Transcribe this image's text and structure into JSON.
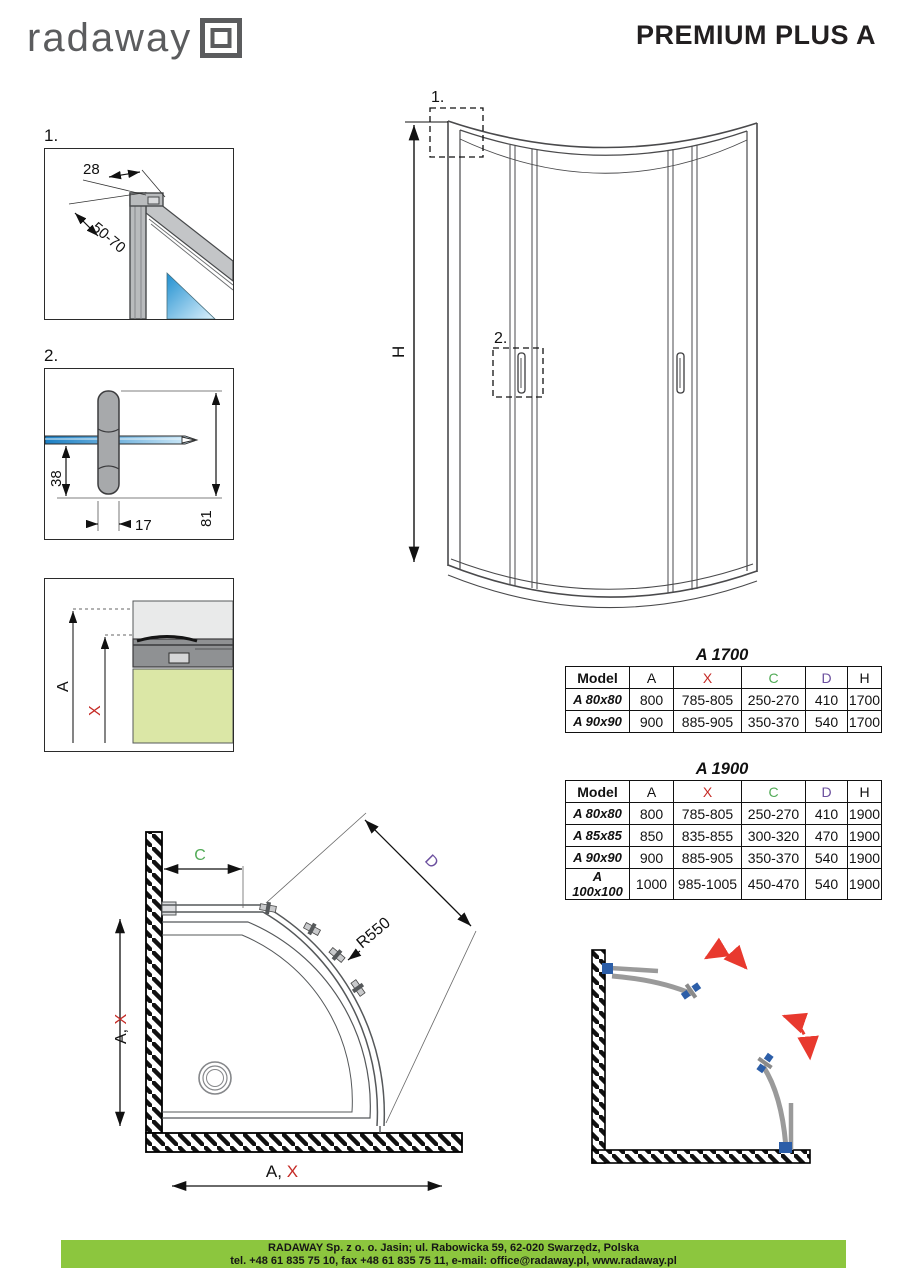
{
  "header": {
    "logo_text": "radaway",
    "title": "PREMIUM PLUS A"
  },
  "details": {
    "one": {
      "label": "1.",
      "dim_width": "28",
      "dim_range": "50-70"
    },
    "two": {
      "label": "2.",
      "dim_depth": "38",
      "dim_width": "17",
      "dim_height": "81"
    },
    "three": {
      "dim_a": "A",
      "dim_x": "X"
    }
  },
  "front_view": {
    "marker_top": "1.",
    "marker_handle": "2.",
    "dim_height": "H"
  },
  "tables": [
    {
      "title": "A 1700",
      "headers": [
        "Model",
        "A",
        "X",
        "C",
        "D",
        "H"
      ],
      "rows": [
        [
          "A 80x80",
          "800",
          "785-805",
          "250-270",
          "410",
          "1700"
        ],
        [
          "A 90x90",
          "900",
          "885-905",
          "350-370",
          "540",
          "1700"
        ]
      ]
    },
    {
      "title": "A 1900",
      "headers": [
        "Model",
        "A",
        "X",
        "C",
        "D",
        "H"
      ],
      "rows": [
        [
          "A 80x80",
          "800",
          "785-805",
          "250-270",
          "410",
          "1900"
        ],
        [
          "A 85x85",
          "850",
          "835-855",
          "300-320",
          "470",
          "1900"
        ],
        [
          "A 90x90",
          "900",
          "885-905",
          "350-370",
          "540",
          "1900"
        ],
        [
          "A 100x100",
          "1000",
          "985-1005",
          "450-470",
          "540",
          "1900"
        ]
      ]
    }
  ],
  "plan_view": {
    "dim_c": "C",
    "dim_d": "D",
    "radius_label": "R550",
    "dim_side_a": "A, ",
    "dim_side_x": "X",
    "dim_front_a": "A, ",
    "dim_front_x": "X"
  },
  "footer": {
    "line1": "RADAWAY Sp. z o. o. Jasin; ul. Rabowicka 59, 62-020 Swarzędz, Polska",
    "line2": "tel. +48 61 835 75 10, fax +48 61 835 75 11, e-mail: office@radaway.pl, www.radaway.pl"
  },
  "colors": {
    "dim_red": "#c52b26",
    "dim_green": "#52ab57",
    "dim_purple": "#6b4f9e",
    "footer_green": "#8cc63e",
    "glass_blue": "#2f9fd8",
    "tray_green": "#dbe7a6"
  }
}
